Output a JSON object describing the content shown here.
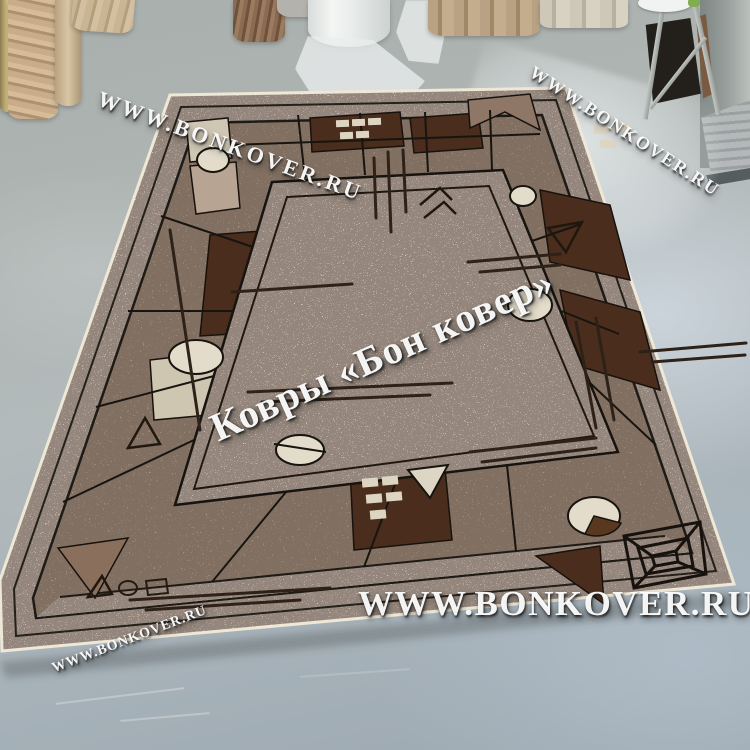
{
  "watermarks": {
    "top_left": {
      "text": "WWW.BONKOVER.RU"
    },
    "top_right": {
      "text": "WWW.BONKOVER.RU"
    },
    "center": {
      "text": "Ковры «Бон ковер»"
    },
    "bottom": {
      "text": "WWW.BONKOVER.RU"
    },
    "bottom_left": {
      "text": "WWW.BONKOVER.RU"
    }
  },
  "colors": {
    "floor_gray": "#aeb5b3",
    "floor_bright_blue": "#bac6d0",
    "rug_field_cream": "#ddd5c2",
    "rug_border_taupe": "#ab9889",
    "rug_dark_brown": "#4a2d1c",
    "rug_outline_black": "#1e1a16",
    "rug_edge_cream": "#efe8d6",
    "watermark_white": "#ffffff"
  }
}
